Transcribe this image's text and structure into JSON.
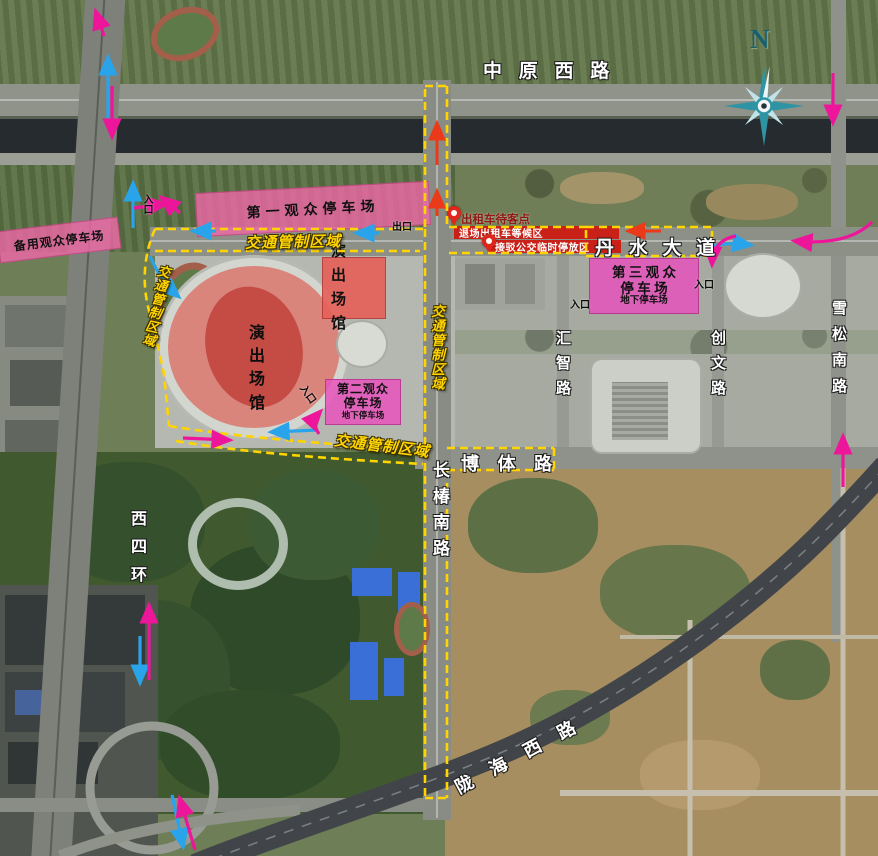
{
  "compass": {
    "north": "N"
  },
  "roads": {
    "zhongyuan_west": "中 原 西 路",
    "danshui": "丹 水 大 道",
    "boti": "博 体 路",
    "changchun_south": "长椿南路",
    "huizhi": "汇智路",
    "chuangwen": "创文路",
    "xuesong_south": "雪松南路",
    "xisihuan": "西四环",
    "longhai_west": "陇 海 西 路"
  },
  "zones": {
    "traffic_control": "交通管制区域"
  },
  "venues": {
    "stadium": {
      "line1": "演 出",
      "line2": "场 馆"
    },
    "hall": {
      "line1": "演 出",
      "line2": "场 馆"
    }
  },
  "parking": {
    "first": {
      "name": "第一观众停车场"
    },
    "backup": {
      "name": "备用观众停车场"
    },
    "second": {
      "line1": "第二观众",
      "line2": "停车场",
      "line3": "地下停车场"
    },
    "third": {
      "line1": "第 三 观 众",
      "line2": "停 车 场",
      "line3": "地下停车场"
    }
  },
  "service": {
    "taxi_stand": "出租车待客点",
    "taxi_exit_wait": "退场出租车等候区",
    "shuttle_bus": "接驳公交临时停放区"
  },
  "gates": {
    "entrance": "入口",
    "exit": "出口"
  },
  "colors": {
    "parking_pink": "#ee68a8",
    "parking_magenta": "#e455c0",
    "venue_red": "#e05f58",
    "restricted_band_red": "#c92118",
    "control_yellow": "#ffd400",
    "arrow_magenta": "#ed169b",
    "arrow_blue": "#29a4ea",
    "arrow_red": "#ea3a1a",
    "compass_teal": "#2e93a3"
  }
}
